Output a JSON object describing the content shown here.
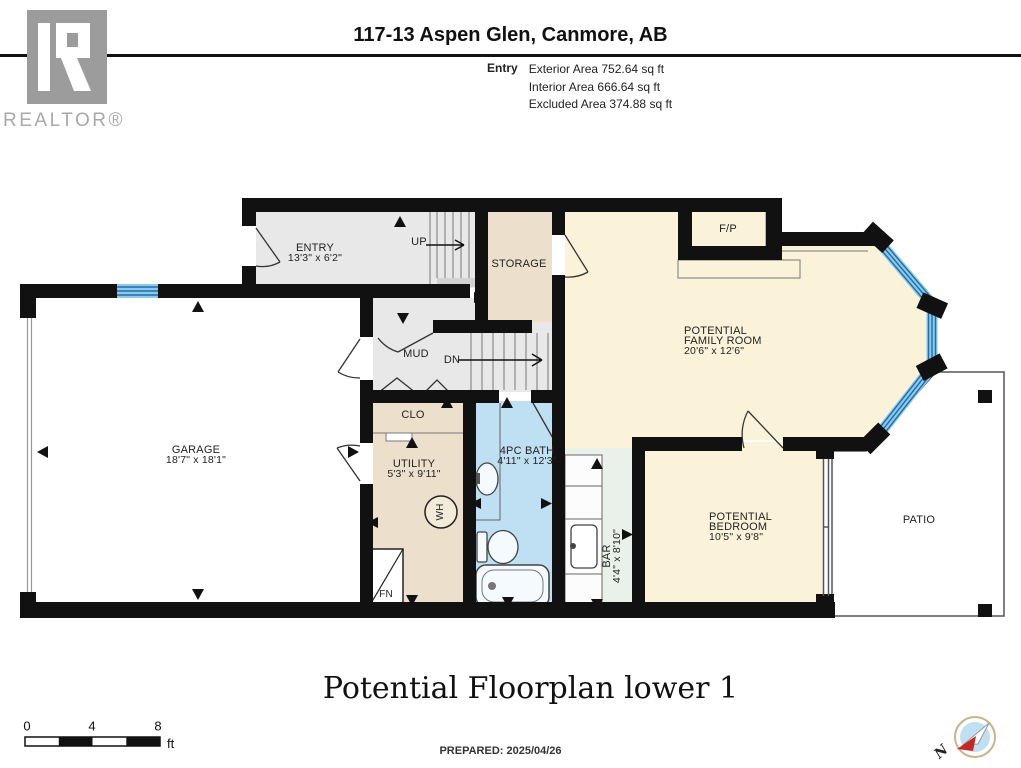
{
  "header": {
    "logo_text": "REALTOR®",
    "title": "117-13 Aspen Glen, Canmore, AB",
    "area_label": "Entry",
    "stats": {
      "exterior": "Exterior Area 752.64 sq ft",
      "interior": "Interior Area 666.64 sq ft",
      "excluded": "Excluded Area 374.88 sq ft"
    }
  },
  "plan": {
    "entry": {
      "name": "ENTRY",
      "dims": "13'3\" x 6'2\""
    },
    "up": "UP",
    "dn": "DN",
    "storage": {
      "name": "STORAGE"
    },
    "fp": {
      "name": "F/P"
    },
    "family": {
      "l1": "POTENTIAL",
      "l2": "FAMILY ROOM",
      "dims": "20'6\" x 12'6\""
    },
    "mud": {
      "name": "MUD"
    },
    "garage": {
      "name": "GARAGE",
      "dims": "18'7\" x 18'1\""
    },
    "clo": {
      "name": "CLO"
    },
    "utility": {
      "name": "UTILITY",
      "dims": "5'3\" x 9'11\""
    },
    "bath": {
      "name": "4PC BATH",
      "dims": "4'11\" x 12'3\""
    },
    "wh": "WH",
    "fn": "FN",
    "bar": {
      "name": "BAR",
      "dims": "4'4\" x 8'10\""
    },
    "bedroom": {
      "l1": "POTENTIAL",
      "l2": "BEDROOM",
      "dims": "10'5\" x 9'8\""
    },
    "patio": {
      "name": "PATIO"
    }
  },
  "footer": {
    "plan_title": "Potential Floorplan lower 1",
    "prepared": "PREPARED: 2025/04/26"
  },
  "scale": {
    "t0": "0",
    "t4": "4",
    "t8": "8",
    "unit": "ft"
  },
  "compass": {
    "north": "N"
  },
  "colors": {
    "wall": "#111111",
    "floor_gray": "#e8e8e8",
    "beige": "#ece0cc",
    "bath_blue": "#bfdff2",
    "cream": "#faf3da",
    "bar_floor": "#eaf0ea",
    "window_blue": "#8ec9ec",
    "window_stripe": "#1d6fa8",
    "needle_red": "#c42727",
    "logo_gray": "#9c9c9c"
  }
}
